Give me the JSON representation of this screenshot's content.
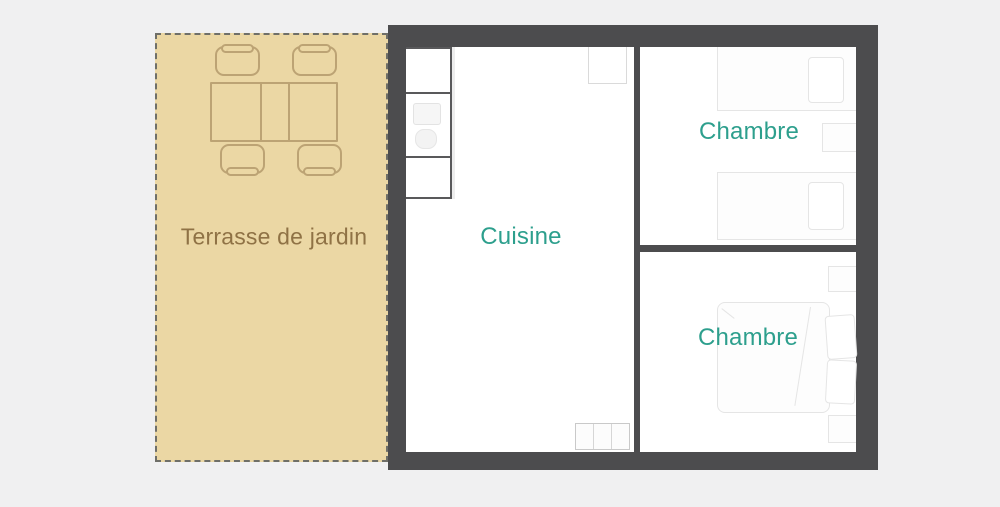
{
  "labels": {
    "terrace": "Terrasse de jardin",
    "cuisine": "Cuisine",
    "chambre_top": "Chambre",
    "chambre_bottom": "Chambre"
  },
  "colors": {
    "page-bg": "#f0f0f1",
    "wall": "#4c4c4e",
    "terrace-bg": "#ebd7a4",
    "terrace-text": "#8f7245",
    "room-label": "#2d9f8d",
    "terrace-line": "#bca374",
    "counter-line": "#59595b",
    "faint-line": "#e5e5e5"
  }
}
